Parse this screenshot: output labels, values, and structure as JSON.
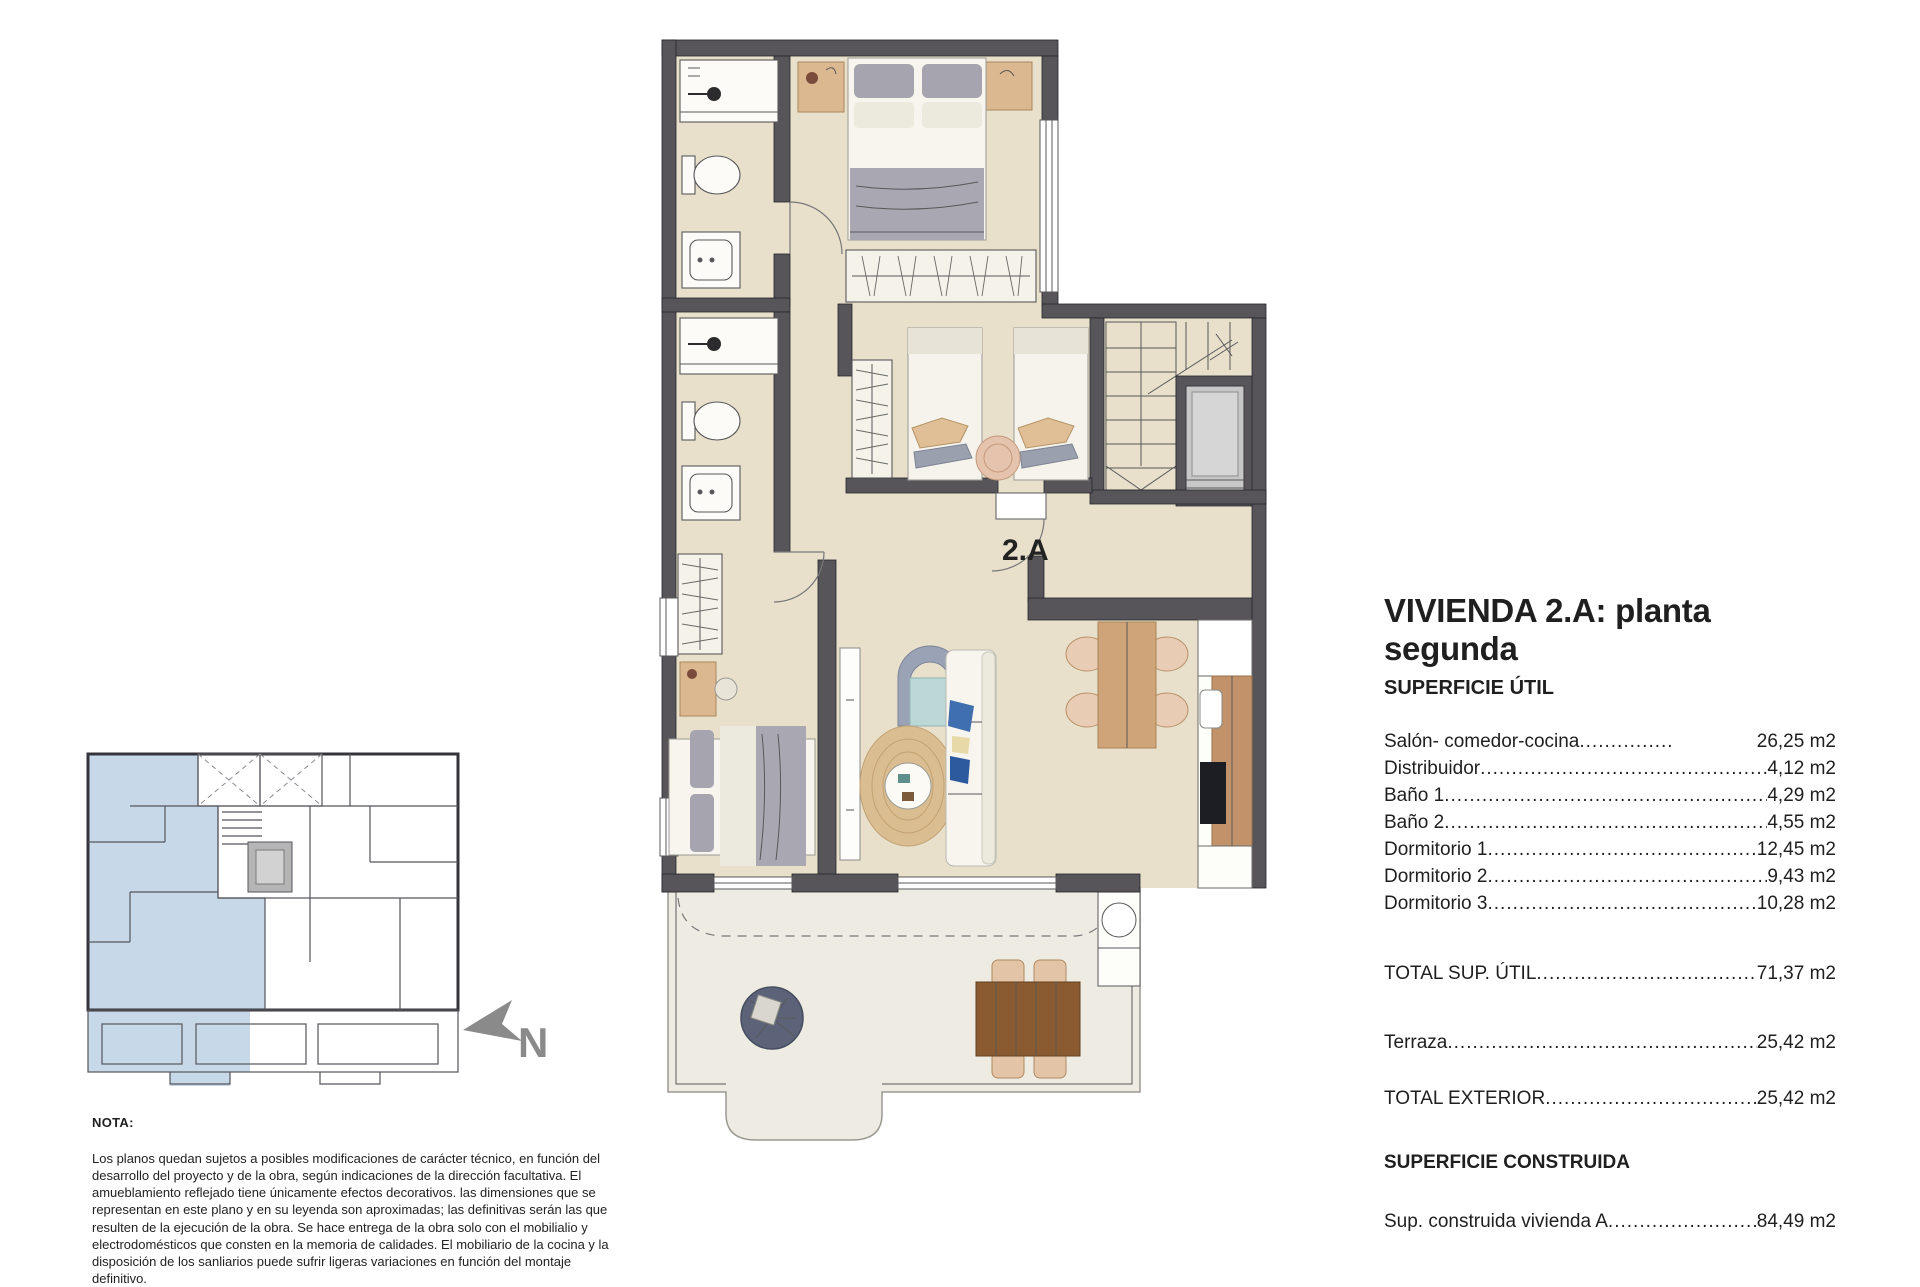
{
  "plan": {
    "unit_label": "2.A"
  },
  "keyplan": {
    "north_label": "N"
  },
  "info": {
    "title": "VIVIENDA 2.A: planta segunda",
    "section1_heading": "SUPERFICIE ÚTIL",
    "rows": [
      {
        "label": "Salón- comedor-cocina",
        "value": "26,25 m2"
      },
      {
        "label": "Distribuidor",
        "value": "4,12 m2"
      },
      {
        "label": "Baño 1",
        "value": "4,29 m2"
      },
      {
        "label": "Baño 2",
        "value": "4,55 m2"
      },
      {
        "label": "Dormitorio 1",
        "value": "12,45 m2"
      },
      {
        "label": "Dormitorio 2",
        "value": "9,43 m2"
      },
      {
        "label": "Dormitorio 3",
        "value": "10,28 m2"
      }
    ],
    "total_util": {
      "label": "TOTAL SUP. ÚTIL",
      "value": "71,37 m2"
    },
    "terraza": {
      "label": "Terraza",
      "value": "25,42 m2"
    },
    "total_exterior": {
      "label": "TOTAL EXTERIOR",
      "value": "25,42 m2"
    },
    "section2_heading": "SUPERFICIE CONSTRUIDA",
    "constructed": {
      "label": "Sup. construida vivienda A",
      "value": "84,49 m2"
    }
  },
  "note": {
    "heading": "NOTA:",
    "body": "Los planos quedan sujetos a posibles modificaciones de carácter técnico, en función del desarrollo del proyecto y de la obra, según indicaciones de la dirección facultativa. El amueblamiento reflejado tiene únicamente efectos decorativos. las dimensiones que se representan en este plano y en su leyenda son aproximadas; las definitivas serán las que resulten de la ejecución de la obra. Se hace entrega de la obra solo con el mobilialio y electrodomésticos que consten en la memoria de calidades. El mobiliario de la cocina y la disposición de los sanliarios puede sufrir ligeras variaciones en función del montaje definitivo."
  },
  "colors": {
    "wall": "#575559",
    "floor": "#e8e0cb",
    "terrace": "#eeece2",
    "blue": "#b9cfe2",
    "arrow": "#8a8a8a"
  }
}
